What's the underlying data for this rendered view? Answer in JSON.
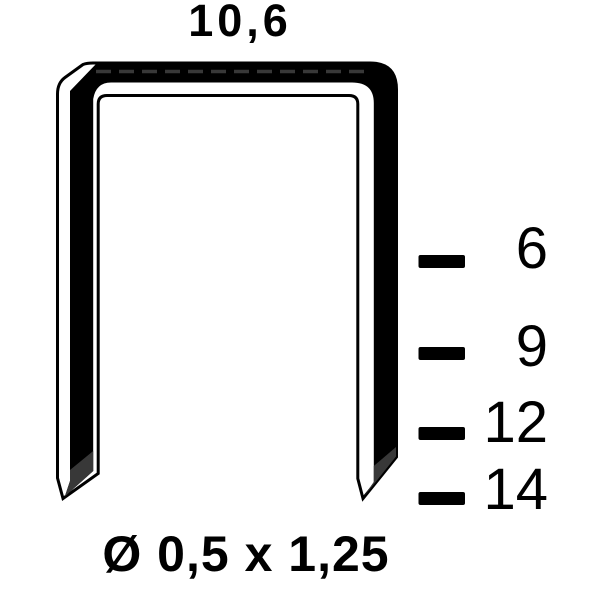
{
  "diagram": {
    "type": "staple-dimension-drawing",
    "crown_width": "10,6",
    "wire_spec": "Ø 0,5 x 1,25",
    "lengths": [
      "6",
      "9",
      "12",
      "14"
    ],
    "colors": {
      "ink": "#000000",
      "bevel_shade": "#383838",
      "highlight": "#ffffff",
      "background": "#ffffff"
    }
  }
}
